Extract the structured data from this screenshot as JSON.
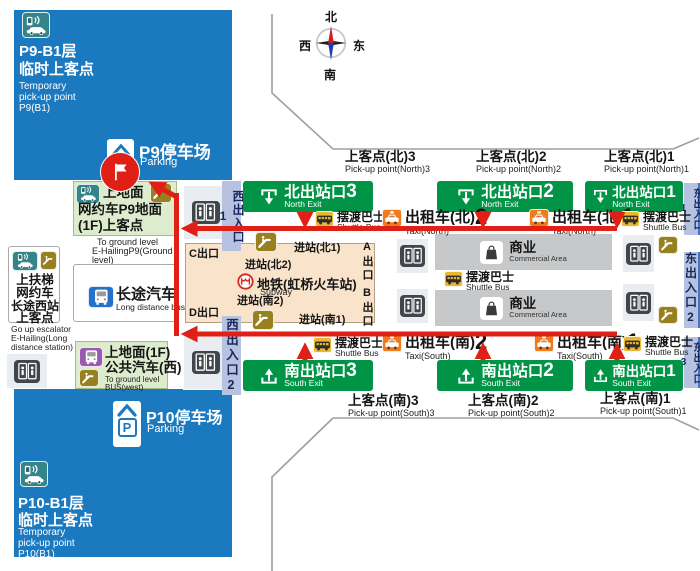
{
  "colors": {
    "panel_blue": "#1b79c0",
    "exit_green": "#019447",
    "route_red": "#e02016",
    "station_beige": "#f9e4cb",
    "pickup_green": "#ddeccd",
    "entrance_strip": "#b6c2e0",
    "taxi_orange": "#ef7b1e",
    "shuttle_yellow": "#eab72f",
    "ehailing_teal": "#33858a",
    "escalator_gold": "#97801f",
    "bus_blue": "#2472c8",
    "bus_purple": "#9a5ab4",
    "commercial_gray": "#c6c8ca"
  },
  "compass": {
    "north": "北",
    "south": "南",
    "east": "东",
    "west": "西"
  },
  "p9": {
    "line1": "P9-B1层",
    "line2": "临时上客点",
    "en1": "Temporary",
    "en2": "pick-up point",
    "en3": "P9(B1)",
    "parking_cn": "P9停车场",
    "parking_en": "Parking"
  },
  "p10": {
    "line1": "P10-B1层",
    "line2": "临时上客点",
    "en1": "Temporary",
    "en2": "pick-up point",
    "en3": "P10(B1)",
    "parking_cn": "P10停车场",
    "parking_en": "Parking",
    "p_letter": "P"
  },
  "ehail_p9_box": {
    "l1": "上地面",
    "l2": "网约车P9地面",
    "l3": "(1F)上客点",
    "en1": "To ground level",
    "en2": "E-HailingP9(Ground",
    "en3": "level)"
  },
  "long_distance_bus": {
    "cn": "长途汽车",
    "en": "Long distance bus"
  },
  "west_pickup": {
    "l1": "上扶梯",
    "l2": "网约车",
    "l3": "长途西站",
    "l4": "上客点",
    "en1": "Go up escalator",
    "en2": "E-Hailing(Long",
    "en3": "distance station)"
  },
  "bus_west": {
    "l1": "上地面(1F)",
    "l2": "公共汽车(西)",
    "en1": "To ground level",
    "en2": "BUS(west)"
  },
  "exits_north": [
    {
      "cn": "北出站口",
      "num": "3",
      "en": "North Exit"
    },
    {
      "cn": "北出站口",
      "num": "2",
      "en": "North Exit"
    },
    {
      "cn": "北出站口",
      "num": "1",
      "en": "North Exit"
    }
  ],
  "exits_south": [
    {
      "cn": "南出站口",
      "num": "3",
      "en": "South Exit"
    },
    {
      "cn": "南出站口",
      "num": "2",
      "en": "South Exit"
    },
    {
      "cn": "南出站口",
      "num": "1",
      "en": "South Exit"
    }
  ],
  "pickup_north": [
    {
      "cn": "上客点(北)3",
      "en": "Pick-up point(North)3"
    },
    {
      "cn": "上客点(北)2",
      "en": "Pick-up point(North)2"
    },
    {
      "cn": "上客点(北)1",
      "en": "Pick-up point(North)1"
    }
  ],
  "pickup_south": [
    {
      "cn": "上客点(南)3",
      "en": "Pick-up point(South)3"
    },
    {
      "cn": "上客点(南)2",
      "en": "Pick-up point(South)2"
    },
    {
      "cn": "上客点(南)1",
      "en": "Pick-up point(South)1"
    }
  ],
  "taxi_north": [
    {
      "cn": "出租车(北)",
      "num": "2",
      "en": "Taxi(North)"
    },
    {
      "cn": "出租车(北)",
      "num": "1",
      "en": "Taxi(North)"
    }
  ],
  "taxi_south": [
    {
      "cn": "出租车(南)",
      "num": "2",
      "en": "Taxi(South)"
    },
    {
      "cn": "出租车(南)",
      "num": "1",
      "en": "Taxi(South)"
    }
  ],
  "shuttle": {
    "cn": "摆渡巴士",
    "en": "Shuttle Bus"
  },
  "entrances_west": [
    "西出入口1",
    "西出入口2"
  ],
  "entrances_east": [
    "东出入口1",
    "东出入口2",
    "东出入口3"
  ],
  "subway": {
    "cn": "地铁(虹桥火车站)",
    "en": "Subway",
    "gate_n1": "进站(北1)",
    "gate_n2": "进站(北2)",
    "gate_s2": "进站(南2)",
    "gate_s1": "进站(南1)",
    "exit_a": "A出口",
    "exit_b": "B出口",
    "exit_c": "C出口",
    "exit_d": "D出口"
  },
  "commercial": {
    "cn": "商业",
    "en": "Commercial Area"
  }
}
